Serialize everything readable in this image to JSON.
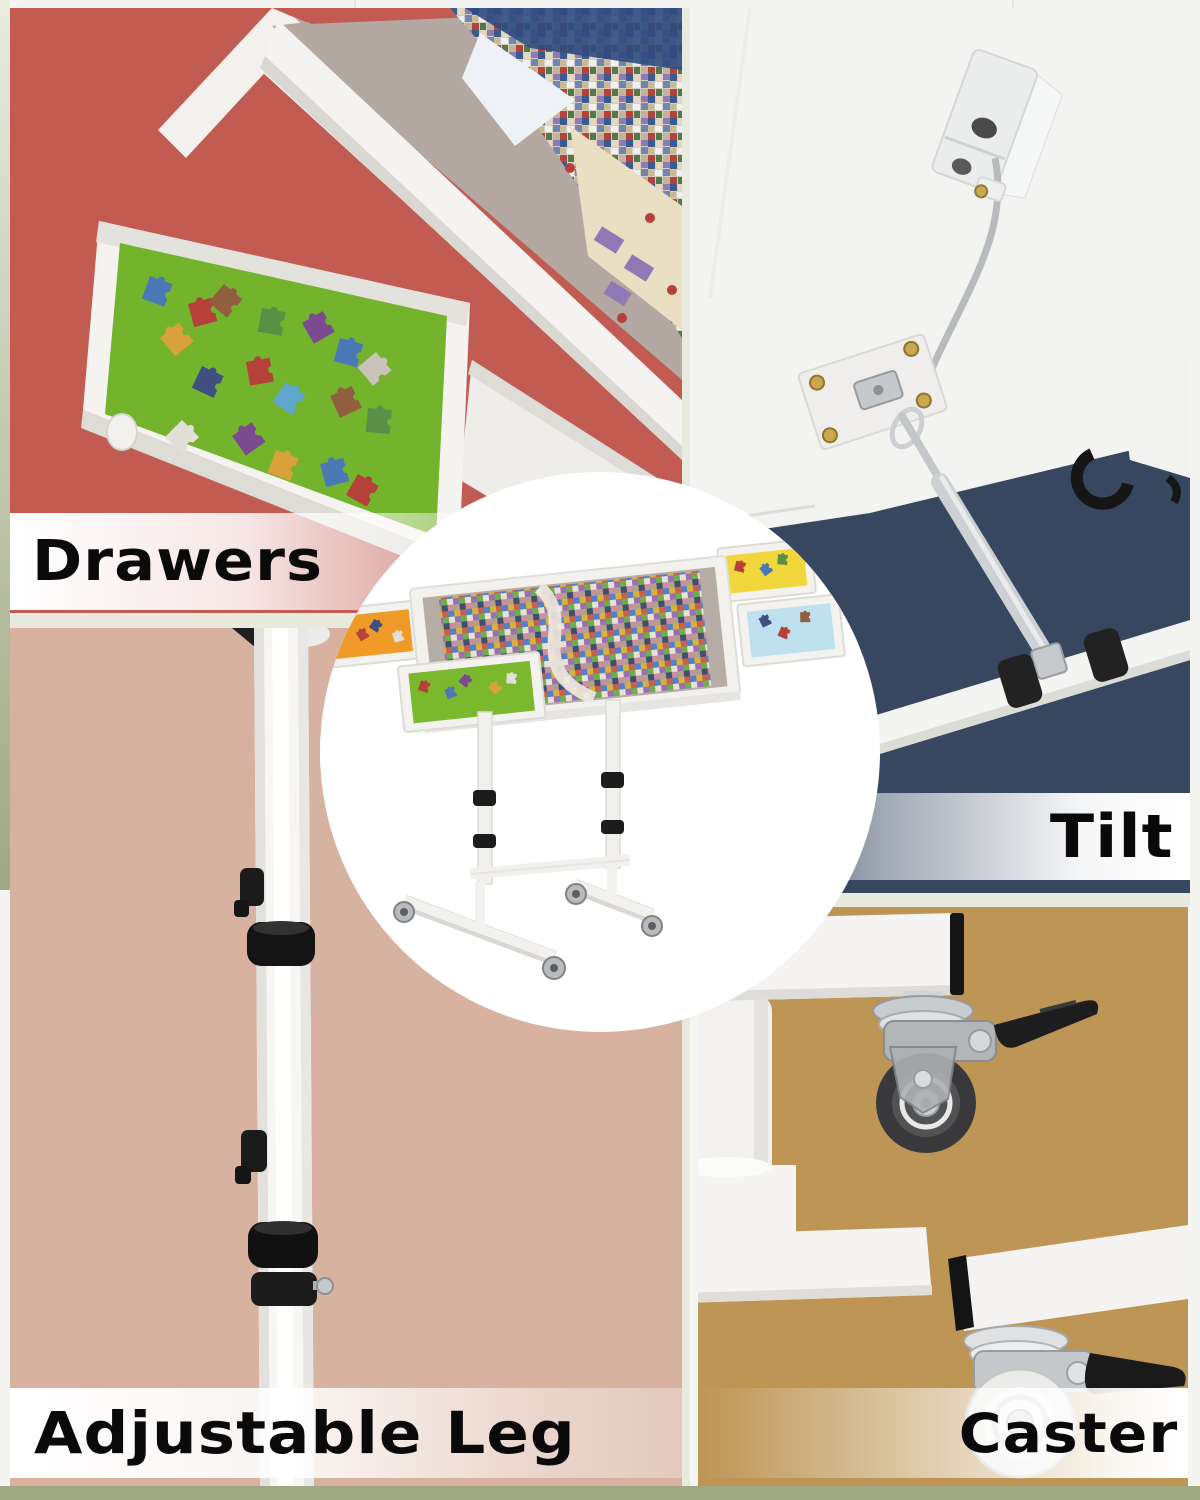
{
  "page": {
    "background_color": "#f4f5f1",
    "edge_strip_color": "#9fa883"
  },
  "features": {
    "drawers": {
      "label": "Drawers",
      "panel_color": "#c25c52"
    },
    "tilt": {
      "label": "Tilt",
      "panel_color": "#36475f"
    },
    "adjustable_leg": {
      "label": "Adjustable Leg",
      "panel_color": "#d8b2a1"
    },
    "caster": {
      "label": "Caster",
      "panel_color": "#bd9555"
    }
  },
  "product": {
    "frame_color": "#f2f1ee",
    "board_felt_color": "#b6ada6",
    "tray_colors": {
      "orange": "#f09a28",
      "green": "#7cb82e",
      "yellow": "#f2d73c",
      "blue": "#bfe0ef"
    }
  }
}
